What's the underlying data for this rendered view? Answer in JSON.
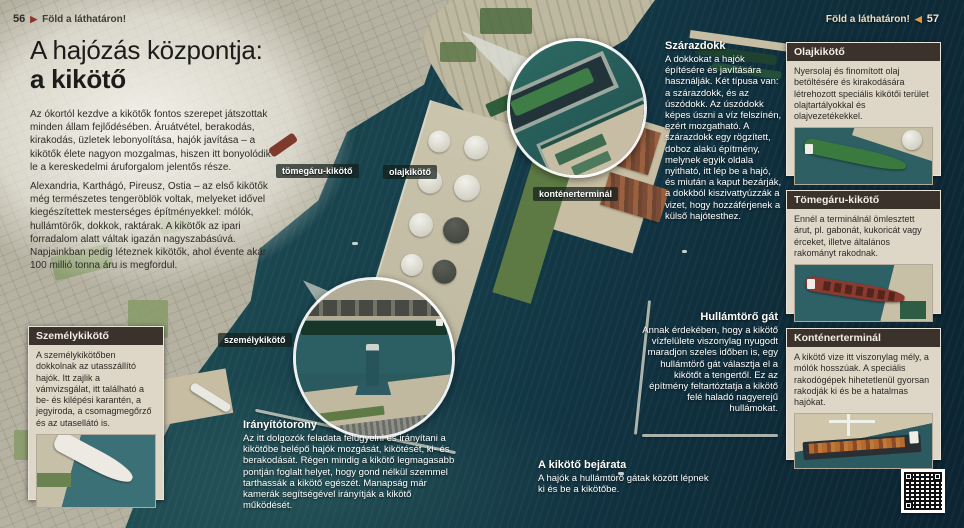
{
  "header": {
    "left_page_number": "56",
    "left_section": "Föld a láthatáron!",
    "right_section": "Föld a láthatáron!",
    "right_page_number": "57"
  },
  "icons": {
    "right_triangle": "▶",
    "left_triangle": "◀"
  },
  "title": {
    "line1": "A hajózás központja:",
    "line2": "a kikötő"
  },
  "intro": {
    "p1": "Az ókortól kezdve a kikötők fontos szerepet játszottak minden állam fejlődésében. Áruátvétel, berakodás, kirakodás, üzletek lebonyolítása, hajók javítása – a kikötők élete nagyon mozgalmas, hiszen itt bonyolódik le a kereskedelmi áruforgalom jelentős része.",
    "p2": "Alexandria, Karthágó, Pireusz, Ostia – az első kikötők még természetes tengeröblök voltak, melyeket idővel kiegészítettek mesterséges építményekkel: mólók, hullámtörők, dokkok, raktárak. A kikötők az ipari forradalom alatt váltak igazán nagyszabásúvá. Napjainkban pedig léteznek kikötők, ahol évente akár 100 millió tonna áru is megfordul."
  },
  "photo_labels": {
    "bulk": "tömegáru-kikötő",
    "oil": "olajkikötő",
    "container": "konténerterminál",
    "passenger": "személykikötő"
  },
  "overlays": {
    "dry_dock": {
      "title": "Szárazdokk",
      "body": "A dokkokat a hajók építésére és javítására használják. Két típusa van: a szárazdokk, és az úszódokk. Az úszódokk képes úszni a víz felszínén, ezért mozgatható. A szárazdokk egy rögzített, doboz alakú építmény, melynek egyik oldala nyitható, itt lép be a hajó, és miután a kaput bezárják, a dokkból kiszivattyúzzák a vizet, hogy hozzáférjenek a külső hajótesthez."
    },
    "breakwater": {
      "title": "Hullámtörő gát",
      "body": "Annak érdekében, hogy a kikötő vízfelülete viszonylag nyugodt maradjon szeles időben is, egy hullámtörő gát választja el a kikötőt a tengertől. Ez az építmény feltartóztatja a kikötő felé haladó nagyerejű hullámokat."
    },
    "harbor_entrance": {
      "title": "A kikötő bejárata",
      "body": "A hajók a hullámtörő gátak között lépnek ki és be a kikötőbe."
    },
    "control_tower": {
      "title": "Irányítótorony",
      "body": "Az itt dolgozók feladata felügyelni és irányítani a kikötőbe belépő hajók mozgását, kikötését, ki- és berakodását. Régen mindig a kikötő legmagasabb pontján foglalt helyet, hogy gond nélkül szemmel tarthassák a kikötő egészét. Manapság már kamerák segítségével irányítják a kikötő működését."
    }
  },
  "info_boxes": {
    "passenger_port": {
      "title": "Személykikötő",
      "body": "A személykikötőben dokkolnak az utasszállító hajók. Itt zajlik a vámvizsgálat, itt található a be- és kilépési karantén, a jegyiroda, a csomagmegőrző és az utasellátó is."
    },
    "oil_port": {
      "title": "Olajkikötő",
      "body": "Nyersolaj és finomított olaj betöltésére és kirakodására létrehozott speciális kikötői terület olajtartályokkal és olajvezetékekkel."
    },
    "bulk_port": {
      "title": "Tömegáru-kikötő",
      "body": "Ennél a terminálnál ömlesztett árut, pl. gabonát, kukoricát vagy érceket, illetve általános rakományt rakodnak."
    },
    "container_terminal": {
      "title": "Konténerterminál",
      "body": "A kikötő vize itt viszonylag mély, a mólók hosszúak. A speciális rakodógépek hihetetlenül gyorsan rakodják ki és be a hatalmas hajókat."
    }
  },
  "colors": {
    "sea_dark": "#0c2433",
    "sea_mid": "#16404b",
    "land": "#b5b2a2",
    "box_background": "#ded7c8",
    "box_header": "#3a322b",
    "left_arrow": "#8e3325",
    "right_arrow": "#e09a3c",
    "label_background": "rgba(20,30,26,0.72)"
  }
}
